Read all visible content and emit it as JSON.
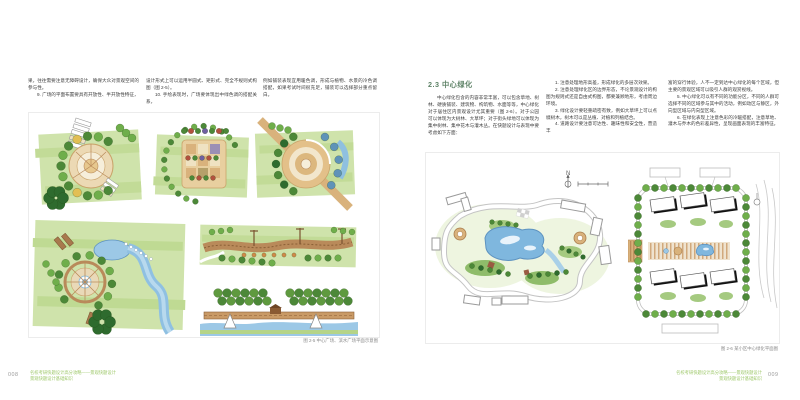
{
  "colors": {
    "accent_green": "#9ec86a",
    "heading_green": "#5d8266",
    "wash_green": "#cfe3ab",
    "tree_dark_green": "#4c8838",
    "tree_light_green": "#6fae4b",
    "water_blue": "#7fb7de",
    "paving_tan": "#d9b27c",
    "caption_gray": "#8a8a8a"
  },
  "left_page": {
    "page_number": "008",
    "col1": {
      "p1": "果，往往需要注意无障碍设计，确保大众对景观空间的参与性。",
      "p2": "9. 广场的平面布置要具有开放性、半开放性特征，"
    },
    "col2": {
      "p1": "设计形式上可以运用半圆式、矩形式、完全不规则式构图（图 2-5）。",
      "p2": "10. 手绘表现时，广场要体现出中绿色调的搭配关系，"
    },
    "col3": {
      "p1": "例如铺装表现宜用暖色调，形成与植物、水景的冷色调搭配，如果考试时间很充足，铺装可以选择部分重点留白。"
    },
    "caption": "图 2-5 中心广场、滨水广场平面示意图"
  },
  "right_page": {
    "page_number": "009",
    "heading": "2.3 中心绿化",
    "col1": {
      "p1": "中心绿化包含的内容非常丰富，可以包含草地、树林、硬质铺装、建筑物、构筑物、水面等等，中心绿化对于居住区内景观设计尤其重要（图 2-6）。对于公园可以体现为大树林、大草坪；对于街头绿地可以体现为集中树林、集中花木与灌木丛。在快题设计与表现中要考虑如下方面："
    },
    "col2": {
      "p1": "1. 注意处理地形高差，形成绿化的多层次效果。",
      "p2": "2. 注意处理绿化区的边界形态，不论景观设计的构图为规则式还是自由式构图，都要兼顾地形，考虑周边环境。",
      "p3": "3. 绿化设计要轻重疏密有致，例如大草坪上可以点缀树木，树木可以是丛植、对植和列植结合。",
      "p4": "4. 道路设计要注意可达性、趣味性和安全性，营造丰"
    },
    "col3": {
      "p1": "富的穿行体验，人不一定到达中心绿化的每个区域，但主要的景观区域可以吸引人群的观赏视线。",
      "p2": "5. 中心绿化可以有不同的功能分区，不同的人群可选择不同的区域参与其中的活动，例如动区与静区，外向型区域与内向型区域。",
      "p3": "6. 在绿化表现上注意色彩的冷暖搭配，注意草地、灌木与乔木的色彩差异性，呈现画面表现的丰富特征。"
    },
    "caption": "图 2-6 某小区中心绿化平面图",
    "compass_label": "N"
  },
  "footer": {
    "book_title": "名校考研快题设计高分攻略——景观快题设计",
    "chapter_title": "景观快题设计基础知识"
  }
}
